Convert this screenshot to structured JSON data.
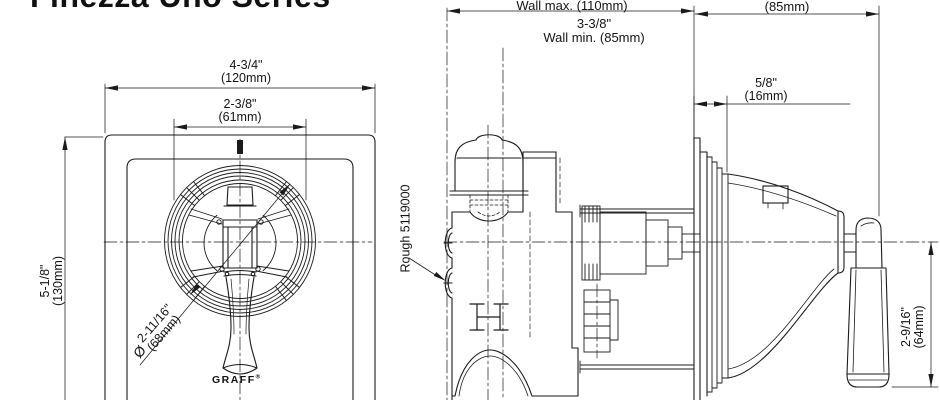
{
  "title": "Finezza Uno Series",
  "brand": {
    "logo": "GRAFF",
    "registered": "®"
  },
  "front_view": {
    "dimensions": {
      "plate_width_in": "4-3/4\"",
      "plate_width_mm": "(120mm)",
      "escutcheon_width_in": "2-3/8\"",
      "escutcheon_width_mm": "(61mm)",
      "plate_height_in": "5-1/8\"",
      "plate_height_mm": "(130mm)",
      "handle_diameter_symbol": "Ø",
      "handle_diameter_in": "2-11/16\"",
      "handle_diameter_mm": "(68mm)"
    }
  },
  "side_view": {
    "labels": {
      "rough_valve": "Rough 5119000"
    },
    "dimensions": {
      "wall_max": "Wall max. (110mm)",
      "wall_min_in": "3-3/8\"",
      "wall_min": "Wall min. (85mm)",
      "projection_mm": "(85mm)",
      "plate_offset_in": "5/8\"",
      "plate_offset_mm": "(16mm)",
      "handle_drop_in": "2-9/16\"",
      "handle_drop_mm": "(64mm)"
    }
  },
  "colors": {
    "line": "#1b1b1b",
    "background": "#ffffff"
  }
}
